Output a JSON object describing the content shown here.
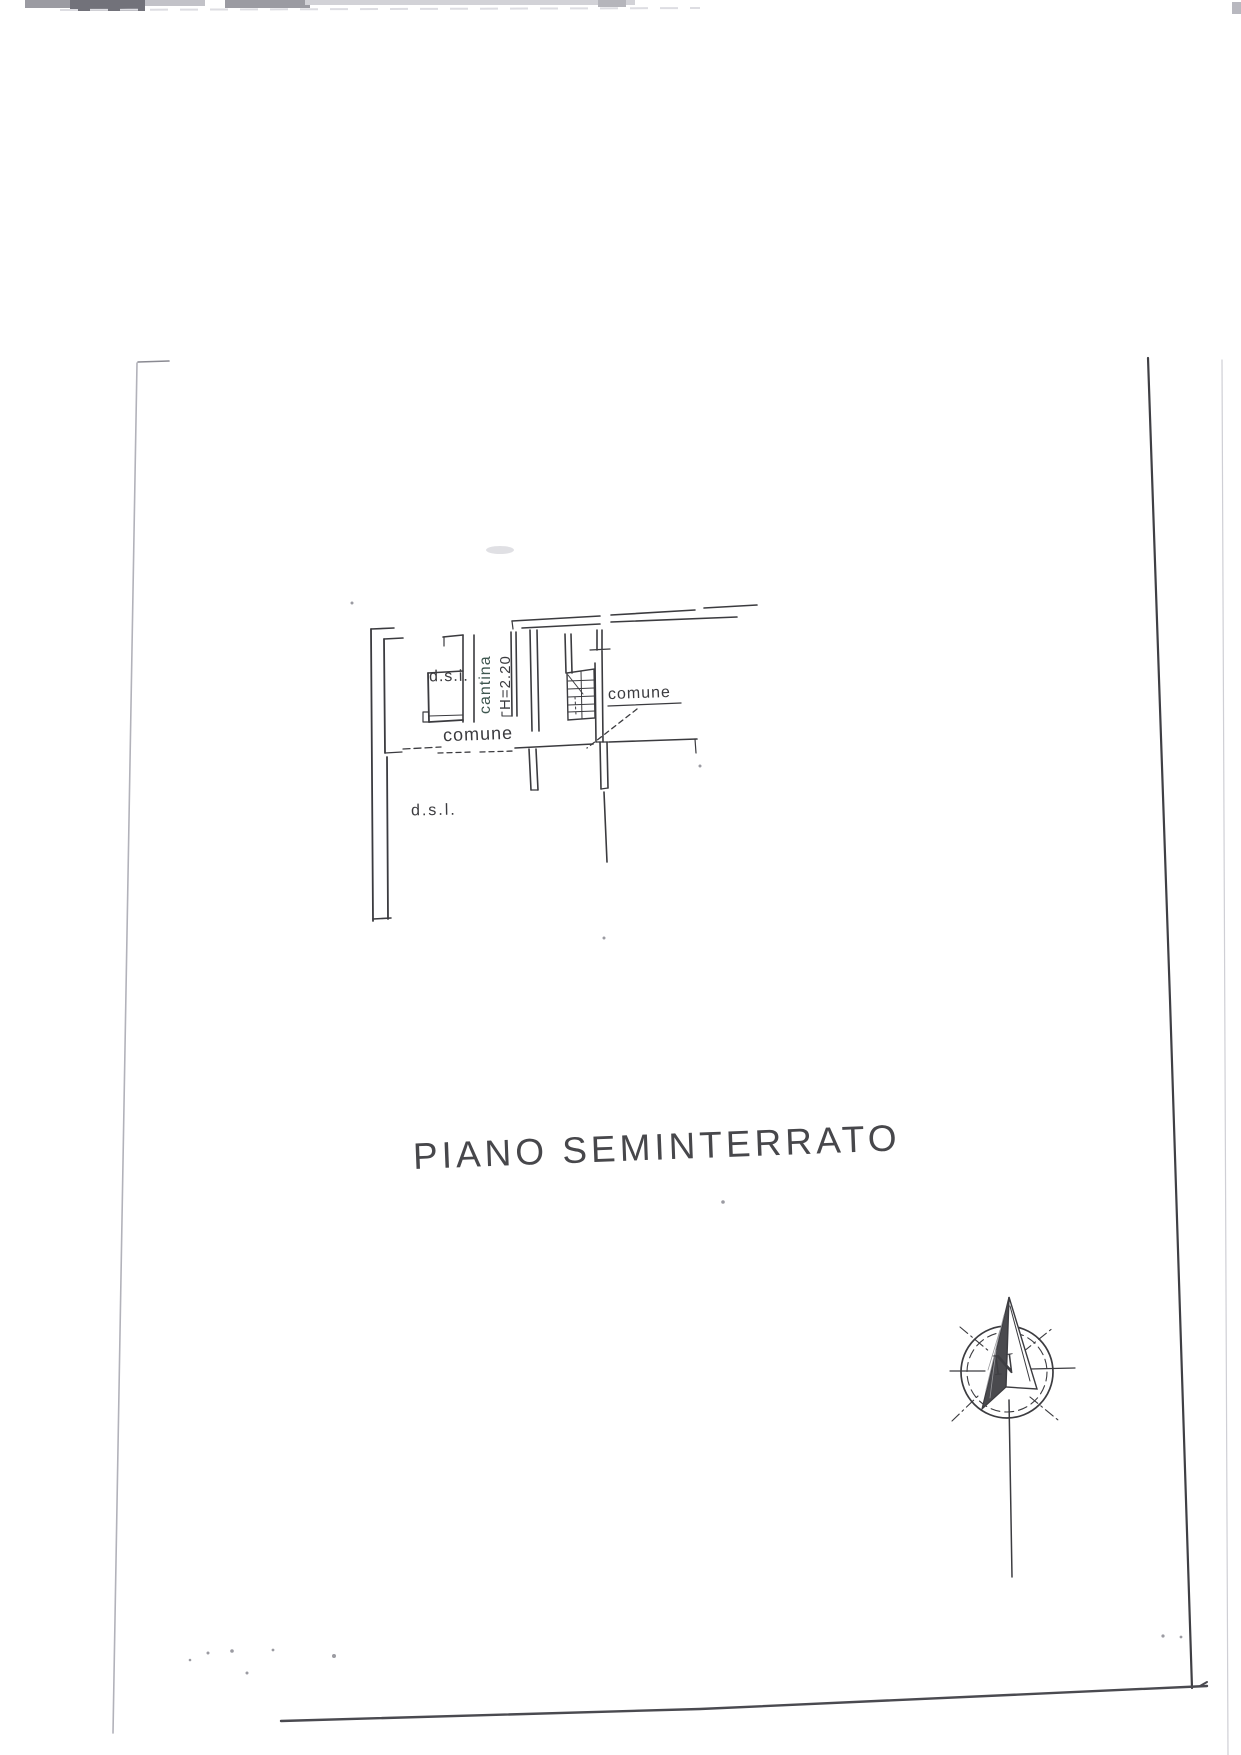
{
  "page": {
    "title": "PIANO SEMINTERRATO"
  },
  "plan": {
    "labels": {
      "dsi": "d.s.i.",
      "cantina": "cantina",
      "cantina_height": "H=2.20",
      "comune_corridor": "comune",
      "comune_stairs": "comune",
      "dsl": "d.s.l."
    }
  },
  "compass": {
    "north_label": "N"
  },
  "colors": {
    "ink": "#3b3b3f",
    "paper": "#ffffff",
    "faint_border": "#a9a9b2",
    "dark_border": "#3f3f44",
    "cantina_ink": "#3e564f"
  }
}
